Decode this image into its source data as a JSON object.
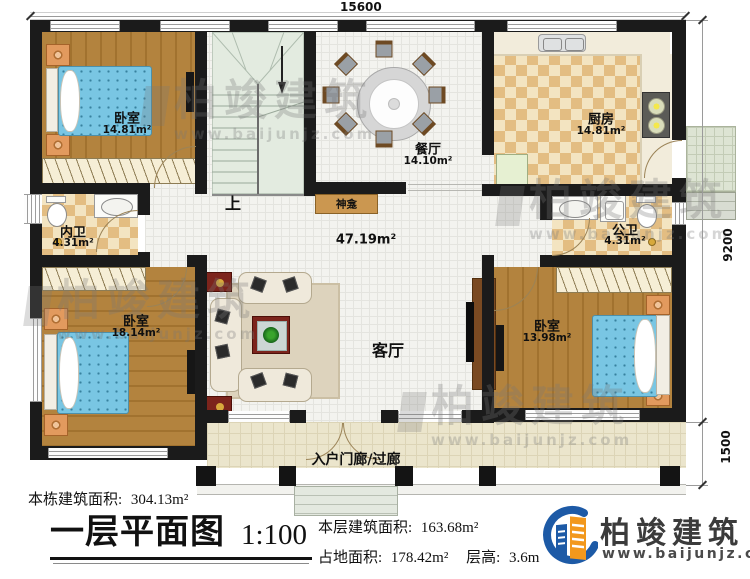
{
  "dimensions": {
    "top": "15600",
    "right": "9200",
    "porch_depth": "1500"
  },
  "rooms": {
    "bedroom_tl": {
      "name": "卧室",
      "area": "14.81m²"
    },
    "dining": {
      "name": "餐厅",
      "area": "14.10m²"
    },
    "kitchen": {
      "name": "厨房",
      "area": "14.81m²"
    },
    "bath_inner": {
      "name": "内卫",
      "area": "4.31m²"
    },
    "bath_public": {
      "name": "公卫",
      "area": "4.31m²"
    },
    "bedroom_bl": {
      "name": "卧室",
      "area": "18.14m²"
    },
    "bedroom_br": {
      "name": "卧室",
      "area": "13.98m²"
    },
    "living": {
      "name": "客厅",
      "area": "47.19m²"
    },
    "shrine": {
      "name": "神龛"
    },
    "stairs": {
      "direction_label": "上"
    },
    "porch": {
      "name": "入户门廊/过廊"
    }
  },
  "footer": {
    "building_total_label": "本栋建筑面积:",
    "building_total_value": "304.13m²",
    "plan_title": "一层平面图",
    "plan_scale": "1:100",
    "floor_area_label": "本层建筑面积:",
    "floor_area_value": "163.68m²",
    "land_area_label": "占地面积:",
    "land_area_value": "178.42m²",
    "floor_height_label": "层高:",
    "floor_height_value": "3.6m"
  },
  "branding": {
    "company_name": "柏竣建筑",
    "website": "www.baijunjz.com"
  },
  "watermark": {
    "text": "柏竣建筑",
    "subtext": "www.baijunjz.com"
  },
  "icons": {
    "logo": "baijun-building-logo",
    "watermark_logo": "baijun-building-logo-grey"
  },
  "colors": {
    "wall": "#1b1b1b",
    "wood_floor": "#b3833e",
    "tile_floor": "#f3f3ef",
    "checker_floor": "#e3bd82",
    "stair_floor": "#e3ebe0",
    "porch_floor": "#ebe5cc",
    "bed": "#79c6e3",
    "shrine_cabinet": "#cb9750",
    "logo_blue": "#1d5aa6",
    "logo_orange": "#f2981d"
  }
}
